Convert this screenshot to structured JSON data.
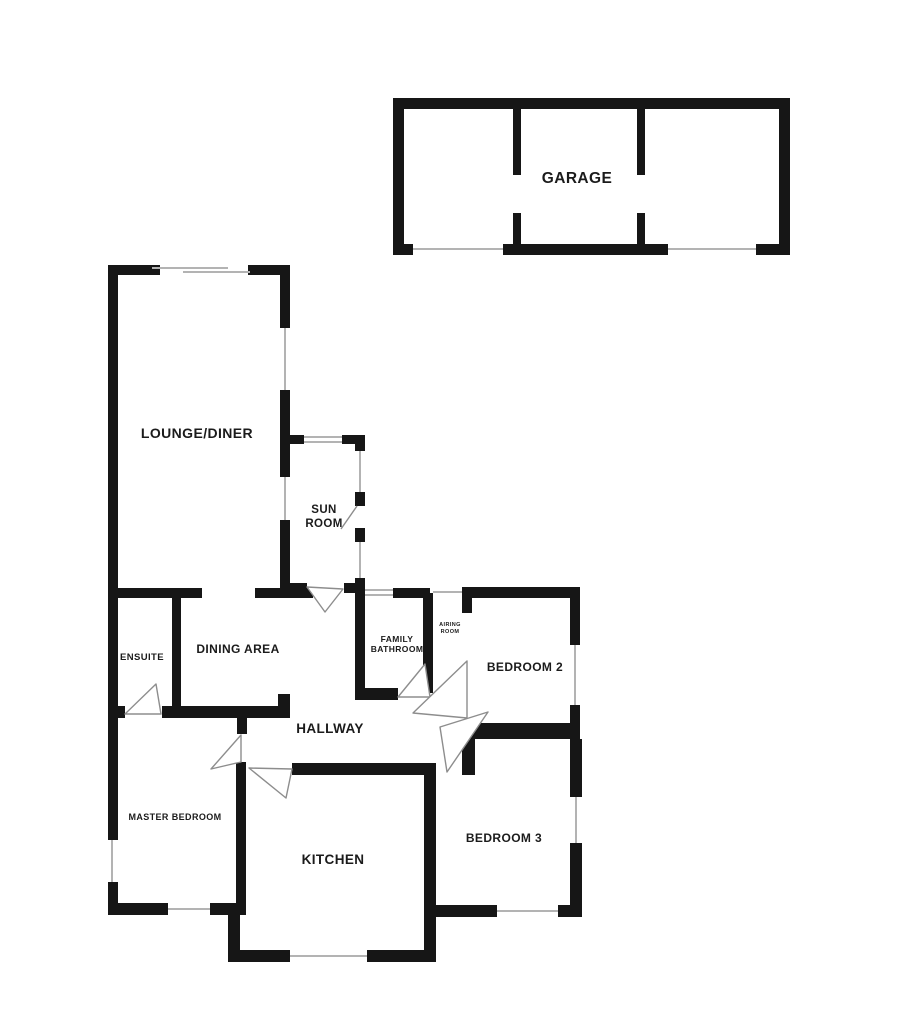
{
  "plan": {
    "type": "residential-floorplan",
    "rooms": {
      "garage": "GARAGE",
      "lounge_diner": "LOUNGE/DINER",
      "sun_room_l1": "SUN",
      "sun_room_l2": "ROOM",
      "ensuite": "ENSUITE",
      "dining_area": "DINING AREA",
      "family_bathroom_l1": "FAMILY",
      "family_bathroom_l2": "BATHROOM",
      "airing_room_l1": "AIRING",
      "airing_room_l2": "ROOM",
      "bedroom_2": "BEDROOM 2",
      "hallway": "HALLWAY",
      "master_bedroom": "MASTER BEDROOM",
      "kitchen": "KITCHEN",
      "bedroom_3": "BEDROOM 3"
    },
    "colors": {
      "wall": "#161616",
      "window": "#b3b3b3",
      "door": "#8d8d8d",
      "background": "#ffffff",
      "text": "#1b1b1b"
    }
  }
}
